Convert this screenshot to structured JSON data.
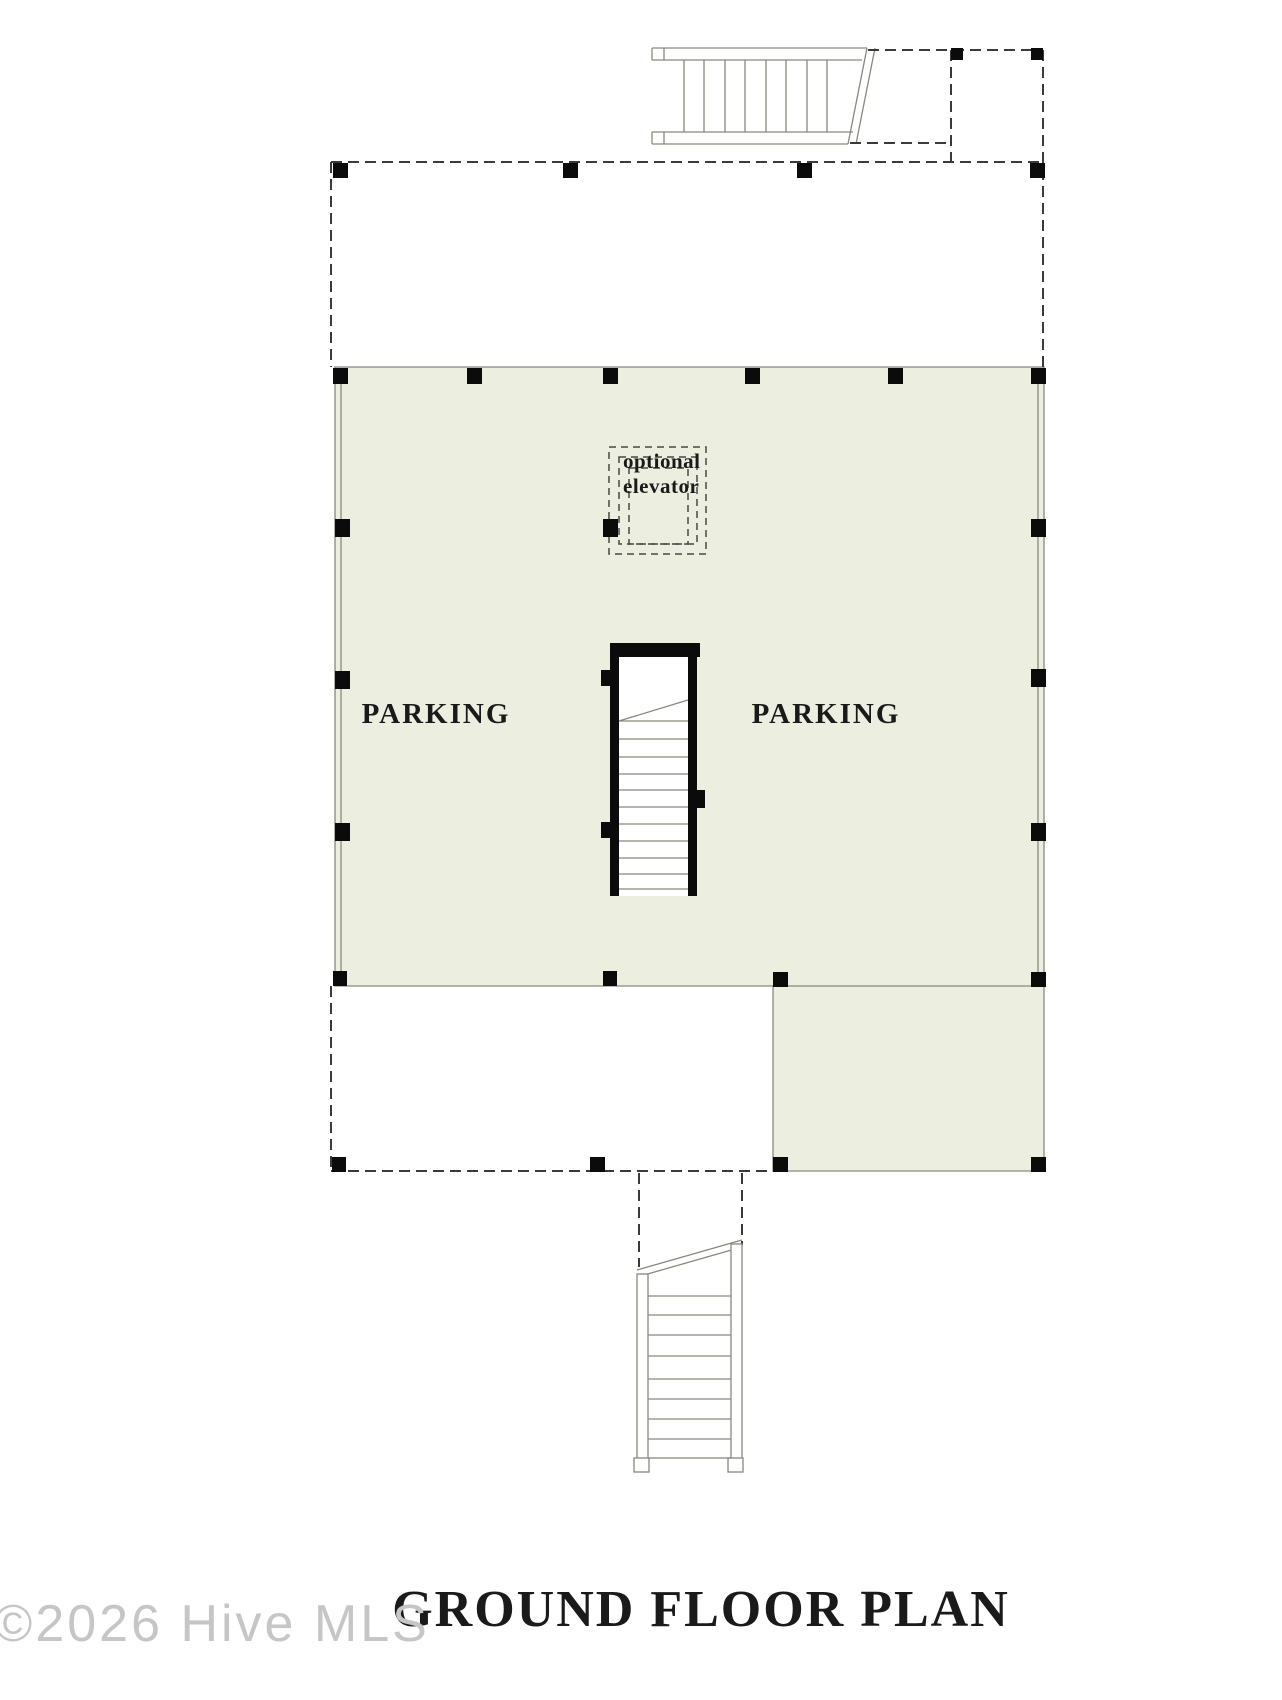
{
  "plan": {
    "title": "GROUND FLOOR PLAN",
    "watermark": "©2026 Hive MLS",
    "labels": {
      "parking_left": "PARKING",
      "parking_right": "PARKING"
    },
    "elevator": {
      "line1": "optional",
      "line2": "elevator"
    }
  },
  "colors": {
    "background": "#ffffff",
    "slab": "#eceee0",
    "thin_line": "#868a7d",
    "dashed_line": "#3a3a3a",
    "wall": "#0b0b0b",
    "text_color": "#1a1a1a",
    "watermark_color": "#c6c6c6"
  }
}
